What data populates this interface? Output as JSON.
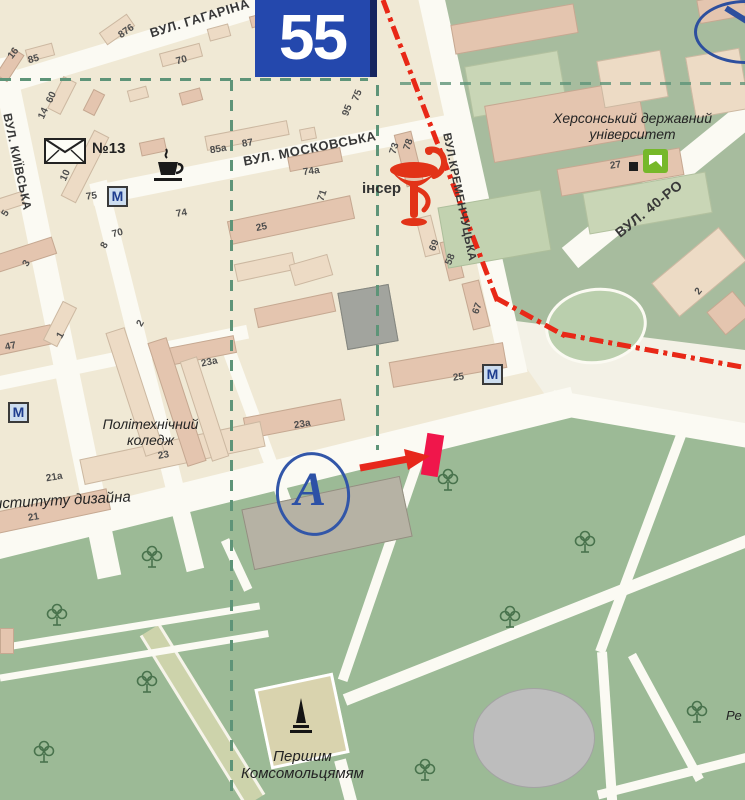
{
  "sign": {
    "number": "55"
  },
  "streets": {
    "haharina": "ВУЛ. ГАГАРІНА",
    "kyivska": "ВУЛ. КИЇВСЬКА",
    "moskovska": "ВУЛ. МОСКОВСЬКА",
    "kremenchutska": "ВУЛ.КРЕМЕНЧУЦЬКА",
    "rokiv40": "ВУЛ. 40-РО"
  },
  "places": {
    "university": [
      "Херсонський державний",
      "університет"
    ],
    "college": [
      "Політехнічний",
      "коледж"
    ],
    "design_institute": "нституту дизайна",
    "monument": [
      "Першим",
      "Комсомольцямям"
    ],
    "post_office": "№13",
    "pharmacy_partial": "інсер",
    "right_edge_partial": "Ре"
  },
  "symbols": {
    "m_box": "М",
    "marker_a": "А"
  },
  "colors": {
    "sign_blue": "#2448ad",
    "boundary_red": "#e82817",
    "annotation_red": "#f0164b",
    "marker_blue": "#2d51a6",
    "park_green": "#9cba96",
    "dash_green": "#5e9478",
    "building_beige": "#eddbc5",
    "building_pink": "#e4c5af",
    "bank_green": "#76b82a"
  },
  "building_numbers": [
    {
      "t": "876",
      "x": 118,
      "y": 26,
      "r": -35
    },
    {
      "t": "16",
      "x": 8,
      "y": 48,
      "r": -52
    },
    {
      "t": "85",
      "x": 28,
      "y": 54,
      "r": -15
    },
    {
      "t": "70",
      "x": 176,
      "y": 55,
      "r": -15
    },
    {
      "t": "60",
      "x": 46,
      "y": 92,
      "r": -65
    },
    {
      "t": "14",
      "x": 38,
      "y": 108,
      "r": -65
    },
    {
      "t": "10",
      "x": 60,
      "y": 170,
      "r": -65
    },
    {
      "t": "75",
      "x": 86,
      "y": 191,
      "r": -8
    },
    {
      "t": "85а",
      "x": 210,
      "y": 144,
      "r": -10
    },
    {
      "t": "87",
      "x": 242,
      "y": 138,
      "r": -10
    },
    {
      "t": "75",
      "x": 352,
      "y": 90,
      "r": -68
    },
    {
      "t": "95",
      "x": 342,
      "y": 105,
      "r": -68
    },
    {
      "t": "73",
      "x": 389,
      "y": 143,
      "r": -72
    },
    {
      "t": "78",
      "x": 403,
      "y": 139,
      "r": -72
    },
    {
      "t": "74а",
      "x": 303,
      "y": 166,
      "r": -8
    },
    {
      "t": "71",
      "x": 317,
      "y": 190,
      "r": -72
    },
    {
      "t": "69",
      "x": 429,
      "y": 240,
      "r": -68
    },
    {
      "t": "58",
      "x": 445,
      "y": 254,
      "r": -68
    },
    {
      "t": "67",
      "x": 472,
      "y": 303,
      "r": -70
    },
    {
      "t": "25",
      "x": 256,
      "y": 222,
      "r": -12
    },
    {
      "t": "70",
      "x": 112,
      "y": 228,
      "r": -14
    },
    {
      "t": "8",
      "x": 102,
      "y": 240,
      "r": -60
    },
    {
      "t": "74",
      "x": 176,
      "y": 208,
      "r": -10
    },
    {
      "t": "2",
      "x": 138,
      "y": 318,
      "r": -60
    },
    {
      "t": "3",
      "x": 24,
      "y": 258,
      "r": -60
    },
    {
      "t": "5",
      "x": 3,
      "y": 208,
      "r": -60
    },
    {
      "t": "47",
      "x": 5,
      "y": 341,
      "r": -12
    },
    {
      "t": "1",
      "x": 58,
      "y": 330,
      "r": -60
    },
    {
      "t": "23а",
      "x": 201,
      "y": 357,
      "r": -12
    },
    {
      "t": "23а",
      "x": 294,
      "y": 419,
      "r": -10
    },
    {
      "t": "23",
      "x": 158,
      "y": 450,
      "r": -10
    },
    {
      "t": "21а",
      "x": 46,
      "y": 472,
      "r": -10
    },
    {
      "t": "21",
      "x": 28,
      "y": 512,
      "r": -10
    },
    {
      "t": "25",
      "x": 453,
      "y": 372,
      "r": -8
    },
    {
      "t": "27",
      "x": 610,
      "y": 160,
      "r": -8
    },
    {
      "t": "2",
      "x": 696,
      "y": 286,
      "r": -50
    }
  ],
  "trees": [
    {
      "x": 448,
      "y": 480
    },
    {
      "x": 152,
      "y": 557
    },
    {
      "x": 57,
      "y": 615
    },
    {
      "x": 147,
      "y": 682
    },
    {
      "x": 44,
      "y": 752
    },
    {
      "x": 510,
      "y": 617
    },
    {
      "x": 697,
      "y": 712
    },
    {
      "x": 425,
      "y": 770
    },
    {
      "x": 585,
      "y": 542
    }
  ]
}
